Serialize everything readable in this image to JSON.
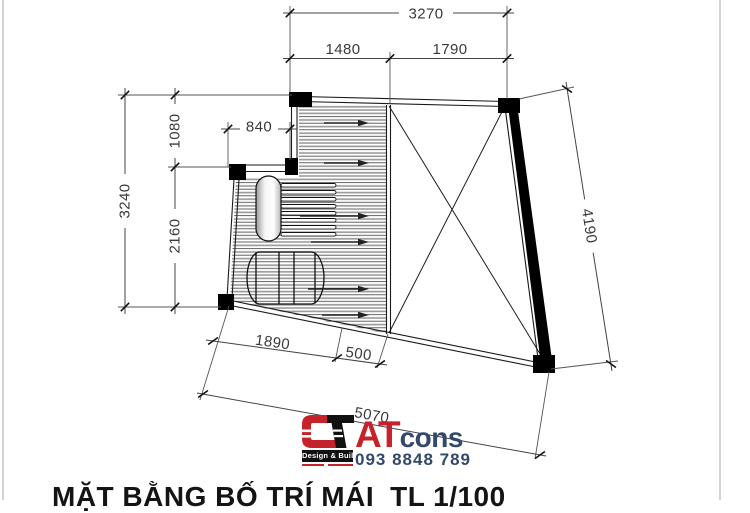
{
  "drawing": {
    "name": "roof-layout-plan",
    "dimensions": {
      "top_total": "3270",
      "top_seg_left": "1480",
      "top_seg_right": "1790",
      "left_total": "3240",
      "left_seg_upper": "1080",
      "left_seg_lower": "2160",
      "step_width": "840",
      "right_total": "4190",
      "bottom_seg_left": "1890",
      "bottom_seg_mid": "500",
      "bottom_total": "5070"
    }
  },
  "logo": {
    "brand_primary": "AT",
    "brand_secondary": "cons",
    "tagline": "Design & Build",
    "phone": "093 8848 789",
    "colors": {
      "red": "#c4232b",
      "navy": "#33496b"
    }
  },
  "title_block": {
    "title": "MẶT BẰNG BỐ TRÍ MÁI",
    "scale": "TL 1/100"
  }
}
